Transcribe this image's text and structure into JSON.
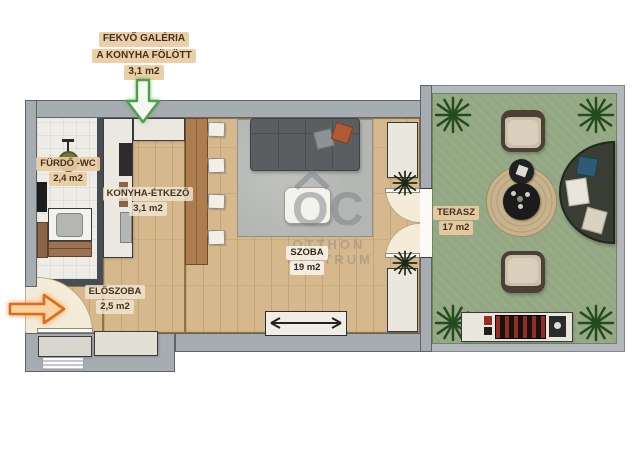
{
  "annotations": {
    "gallery_note": {
      "line1": "FEKVŐ GALÉRIA",
      "line2": "A KONYHA FÖLÖTT",
      "area": "3,1 m2"
    }
  },
  "rooms": {
    "bathroom": {
      "name": "FÜRDŐ -WC",
      "area": "2,4 m2"
    },
    "kitchen_dining": {
      "name": "KONYHA-ÉTKEZŐ",
      "area": "3,1 m2"
    },
    "living_room": {
      "name": "SZOBA",
      "area": "19 m2"
    },
    "hallway": {
      "name": "ELŐSZOBA",
      "area": "2,5 m2"
    },
    "terrace": {
      "name": "TERASZ",
      "area": "17 m2"
    }
  },
  "watermark": {
    "logo_text": "OC",
    "name_line1": "OTTHON",
    "name_line2": "CENTRUM"
  },
  "icons": {
    "gallery_arrow": "arrow-down-icon",
    "entrance_arrow": "arrow-right-icon",
    "watermark_roof": "roof-icon",
    "corner_plants": "plant-icon",
    "radiator_symbol": "double-arrow-icon"
  },
  "colors": {
    "wall": "#a7acb1",
    "wall_outline": "#5f646a",
    "wood_floor": "#d6b88d",
    "bathroom_floor": "#edece7",
    "terrace_floor": "#93a782",
    "label_chip": "#e9cba2",
    "label_text": "#44311d",
    "gallery_arrow_green": "#4f9e49",
    "entrance_arrow_orange": "#d96f1e",
    "rug_gray": "#b4b6b3",
    "sofa_gray": "#5a5e60",
    "dining_table_wood": "#ad7d4f",
    "plant_green": "#254a20"
  }
}
